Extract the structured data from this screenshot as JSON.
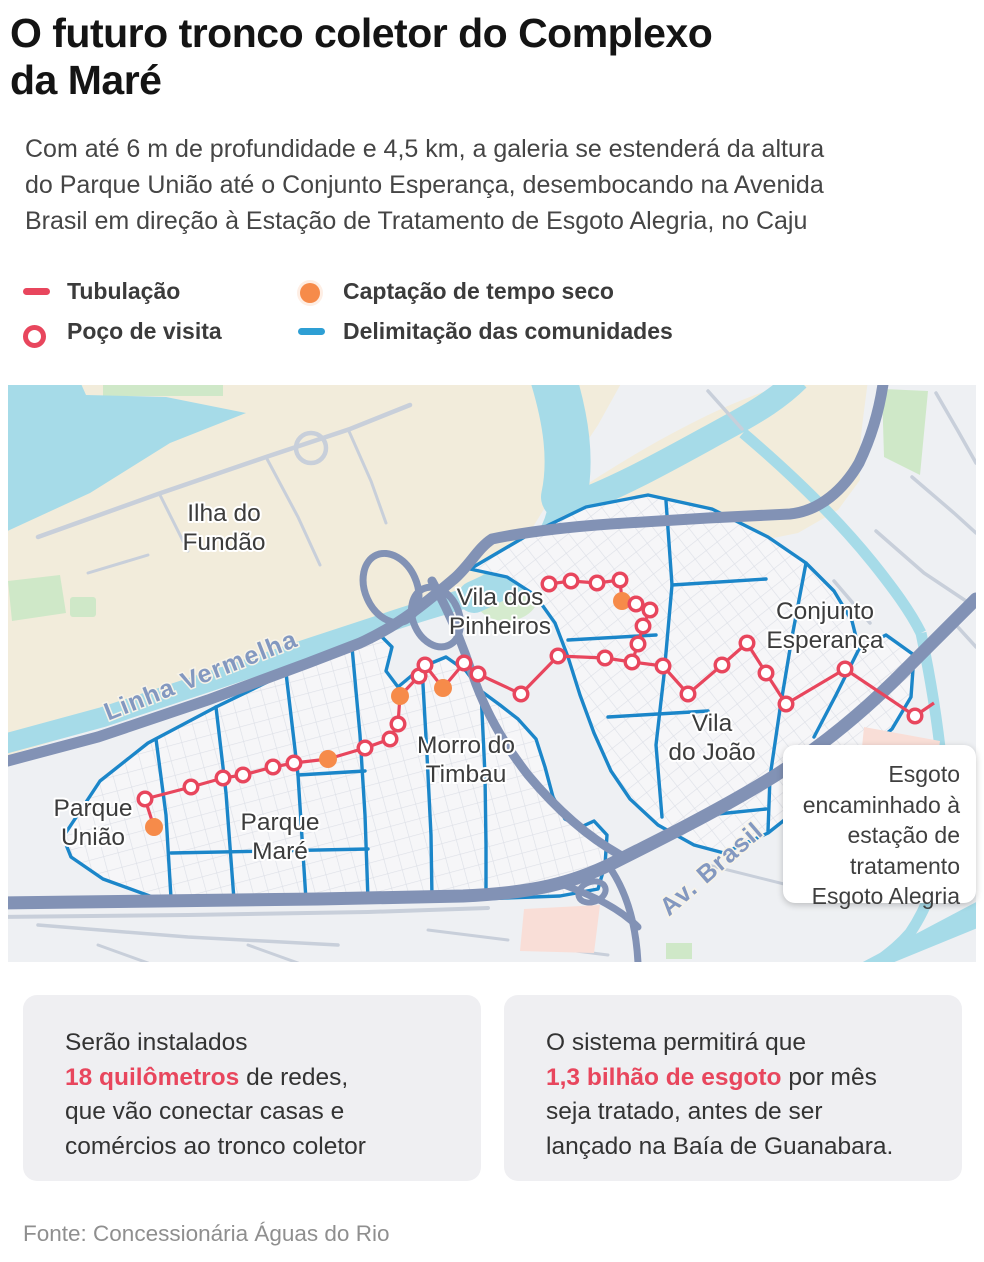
{
  "header": {
    "title_lines": [
      "O futuro tronco coletor do Complexo",
      "da Maré"
    ],
    "subtitle_lines": [
      "Com até 6 m de profundidade e 4,5 km, a galeria se estenderá da altura",
      "do Parque União até o Conjunto Esperança, desembocando na Avenida",
      "Brasil em direção à Estação de Tratamento de Esgoto Alegria, no Caju"
    ]
  },
  "legend": {
    "items": [
      {
        "label": "Tubulação",
        "swatch": "red-line",
        "color": "#e8465d"
      },
      {
        "label": "Poço de visita",
        "swatch": "red-ring",
        "color": "#e8465d"
      },
      {
        "label": "Captação de tempo seco",
        "swatch": "orange-dot",
        "color": "#f68b4a"
      },
      {
        "label": "Delimitação das comunidades",
        "swatch": "blue-line",
        "color": "#2e9fd4"
      }
    ]
  },
  "map": {
    "labels": {
      "ilha_1": "Ilha do",
      "ilha_2": "Fundão",
      "pinheiros_1": "Vila dos",
      "pinheiros_2": "Pinheiros",
      "esperanca_1": "Conjunto",
      "esperanca_2": "Esperança",
      "timbau_1": "Morro do",
      "timbau_2": "Timbau",
      "joao_1": "Vila",
      "joao_2": "do João",
      "uniao_1": "Parque",
      "uniao_2": "União",
      "mare_1": "Parque",
      "mare_2": "Maré"
    },
    "road_labels": {
      "linha_vermelha": "Linha Vermelha",
      "av_brasil": "Av. Brasil"
    },
    "callout": {
      "lines": [
        "Esgoto",
        "encaminhado à",
        "estação de",
        "tratamento",
        "Esgoto Alegria"
      ]
    },
    "pipeline": {
      "trunk": [
        [
          146,
          442
        ],
        [
          137,
          414
        ],
        [
          183,
          402
        ],
        [
          215,
          393
        ],
        [
          235,
          390
        ],
        [
          265,
          382
        ],
        [
          286,
          378
        ],
        [
          320,
          374
        ],
        [
          357,
          363
        ],
        [
          382,
          354
        ],
        [
          390,
          339
        ],
        [
          392,
          311
        ],
        [
          411,
          291
        ],
        [
          417,
          280
        ],
        [
          435,
          303
        ],
        [
          456,
          278
        ],
        [
          470,
          289
        ],
        [
          513,
          309
        ],
        [
          550,
          271
        ],
        [
          597,
          273
        ],
        [
          624,
          277
        ],
        [
          655,
          281
        ],
        [
          680,
          309
        ],
        [
          714,
          280
        ],
        [
          739,
          258
        ],
        [
          758,
          288
        ],
        [
          778,
          319
        ],
        [
          837,
          284
        ],
        [
          907,
          331
        ],
        [
          926,
          318
        ]
      ],
      "branch": [
        [
          541,
          199
        ],
        [
          563,
          196
        ],
        [
          589,
          198
        ],
        [
          612,
          195
        ],
        [
          614,
          216
        ],
        [
          628,
          219
        ],
        [
          642,
          225
        ],
        [
          635,
          241
        ],
        [
          630,
          259
        ],
        [
          624,
          277
        ]
      ],
      "manholes": [
        [
          137,
          414
        ],
        [
          183,
          402
        ],
        [
          215,
          393
        ],
        [
          235,
          390
        ],
        [
          265,
          382
        ],
        [
          286,
          378
        ],
        [
          357,
          363
        ],
        [
          382,
          354
        ],
        [
          390,
          339
        ],
        [
          411,
          291
        ],
        [
          417,
          280
        ],
        [
          456,
          278
        ],
        [
          470,
          289
        ],
        [
          513,
          309
        ],
        [
          550,
          271
        ],
        [
          597,
          273
        ],
        [
          624,
          277
        ],
        [
          655,
          281
        ],
        [
          680,
          309
        ],
        [
          714,
          280
        ],
        [
          739,
          258
        ],
        [
          758,
          288
        ],
        [
          778,
          319
        ],
        [
          837,
          284
        ],
        [
          907,
          331
        ],
        [
          541,
          199
        ],
        [
          563,
          196
        ],
        [
          589,
          198
        ],
        [
          612,
          195
        ],
        [
          628,
          219
        ],
        [
          642,
          225
        ],
        [
          635,
          241
        ],
        [
          630,
          259
        ]
      ],
      "intakes": [
        [
          146,
          442
        ],
        [
          320,
          374
        ],
        [
          392,
          311
        ],
        [
          435,
          303
        ],
        [
          614,
          216
        ]
      ]
    }
  },
  "info_boxes": [
    {
      "line1": "Serão instalados",
      "highlight": "18 quilômetros",
      "after_highlight": " de redes,",
      "line3": "que vão conectar casas e",
      "line4": "comércios ao tronco coletor"
    },
    {
      "line1": "O sistema permitirá que",
      "highlight": "1,3 bilhão de esgoto",
      "after_highlight": " por mês",
      "line3": "seja tratado, antes de ser",
      "line4": "lançado na Baía de Guanabara."
    }
  ],
  "source": "Fonte: Concessionária Águas do Rio",
  "colors": {
    "pipeline_red": "#e8465d",
    "boundary_blue": "#1b86c9",
    "intake_orange": "#f68b4a",
    "water": "#a6dbe8",
    "highway": "#8292b5"
  }
}
